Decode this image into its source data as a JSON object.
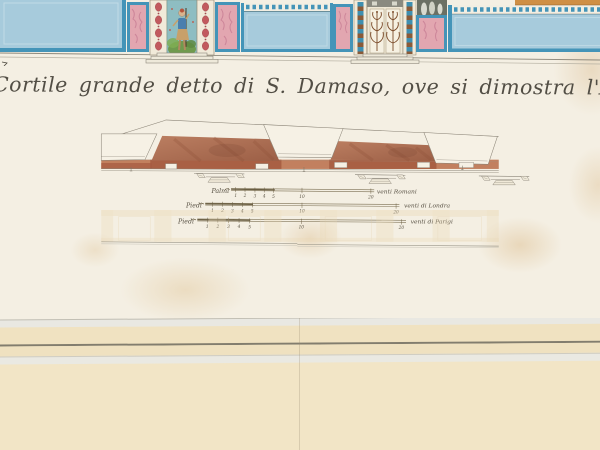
{
  "artwork": {
    "title": "Cortile grande detto di S. Damaso, ove si dimostra l'Archit"
  },
  "scale_bars": [
    {
      "label": "Palmi",
      "units": [
        "1",
        "2",
        "3",
        "4",
        "5"
      ],
      "mid": "10",
      "end": "20",
      "unit_name": "venti Romani"
    },
    {
      "label": "Piedi",
      "units": [
        "1",
        "2",
        "3",
        "4",
        "5"
      ],
      "mid": "10",
      "end": "20",
      "unit_name": "venti di Londra"
    },
    {
      "label": "Piedi",
      "units": [
        "1",
        "2",
        "3",
        "4",
        "5"
      ],
      "mid": "10",
      "end": "20",
      "unit_name": "venti di Parigi"
    }
  ],
  "colors": {
    "paper": "#f4efe3",
    "mat_cream": "#f0e2c1",
    "panel_blue": "#a7cbdc",
    "frame_blue": "#4494b8",
    "marble_pink": "#e2a6b0",
    "poche_brown": "#ad6e52",
    "band_red": "#b4684a",
    "ink": "#524e45"
  }
}
